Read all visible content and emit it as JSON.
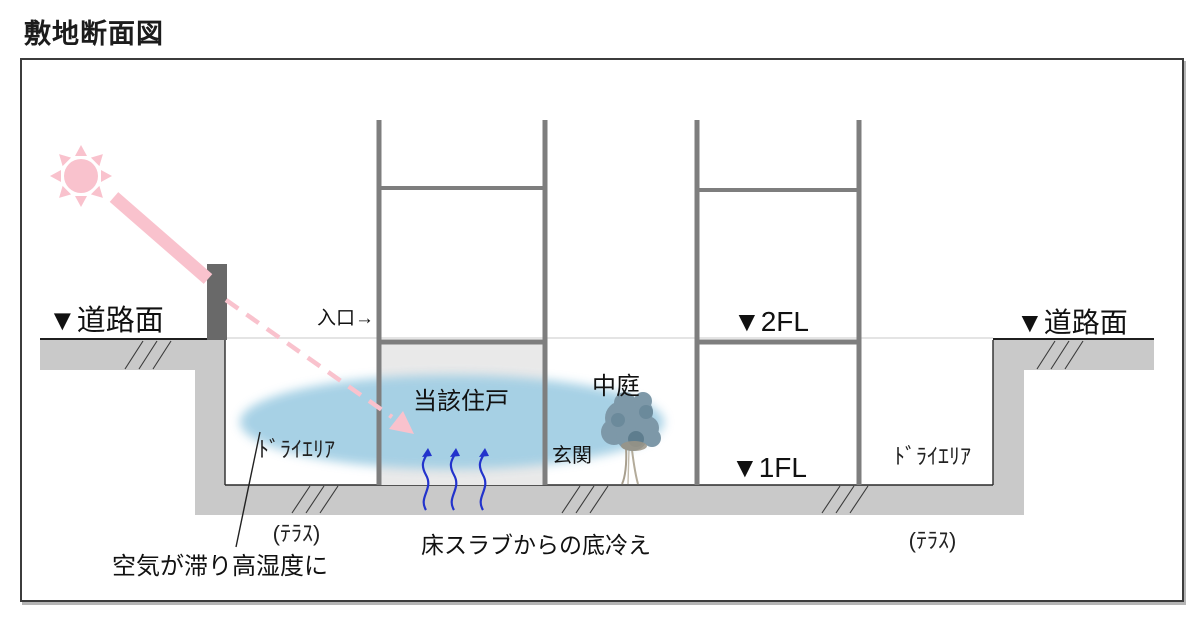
{
  "title": "敷地断面図",
  "diagram": {
    "road_label_left": "▼道路面",
    "road_label_right": "▼道路面",
    "entrance_label": "入口→",
    "unit_label": "当該住戸",
    "courtyard_label": "中庭",
    "door_label": "玄関",
    "dry_area_left": {
      "line1": "ﾄﾞﾗｲｴﾘｱ",
      "line2": "(ﾃﾗｽ)"
    },
    "dry_area_right": {
      "line1": "ﾄﾞﾗｲｴﾘｱ",
      "line2": "(ﾃﾗｽ)"
    },
    "level_2fl_label": "▼2FL",
    "level_1fl_label": "▼1FL",
    "note_humidity": "空気が滞り高湿度に",
    "note_slab_chill": "床スラブからの底冷え",
    "colors": {
      "sun_and_beam": "#f9c2cd",
      "humidity_pool": "#a3cfe4",
      "cold_air_arrows": "#2233cc",
      "ground_fill": "#c9c9c9",
      "structure_stroke": "#7e7e7e",
      "interior_fill": "#e9e9e9",
      "boundary_wall": "#696969",
      "tree_foliage": "#7d98a8"
    }
  }
}
